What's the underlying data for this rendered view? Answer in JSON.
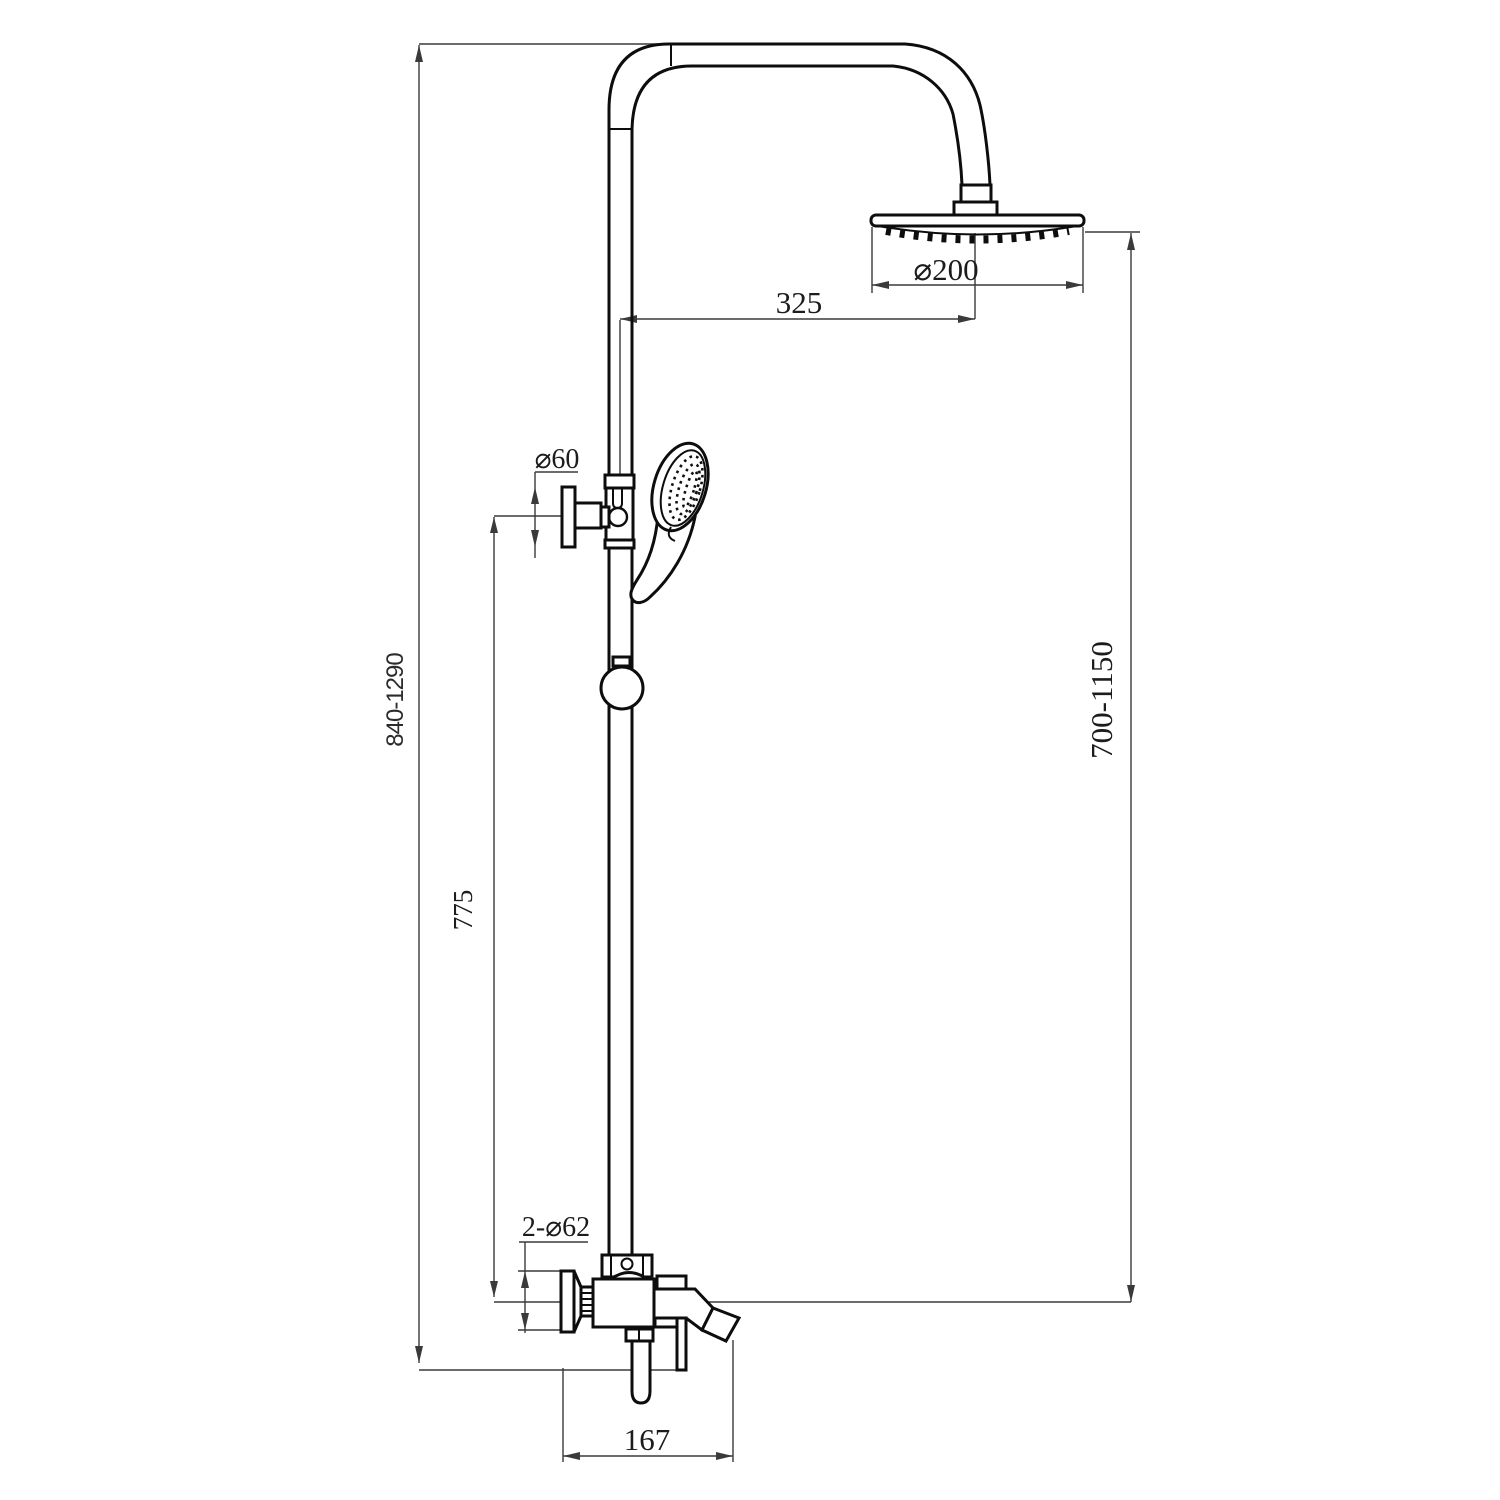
{
  "diagram": {
    "type": "technical-dimension-drawing",
    "subject": "shower column set with rain shower head, hand shower on riser rail and wall-mounted bath mixer, side elevation",
    "background_color": "#ffffff",
    "object_line_color": "#0d0d0d",
    "dimension_line_color": "#3a3a3a",
    "dimensions": {
      "rain_head_diameter": "⌀200",
      "arm_horizontal_offset": "325",
      "holder_diameter": "⌀60",
      "overall_height_range": "840-1290",
      "holder_to_mixer_height": "775",
      "head_to_mixer_height_range": "700-1150",
      "flange_diameter": "2-⌀62",
      "spout_reach": "167"
    }
  }
}
